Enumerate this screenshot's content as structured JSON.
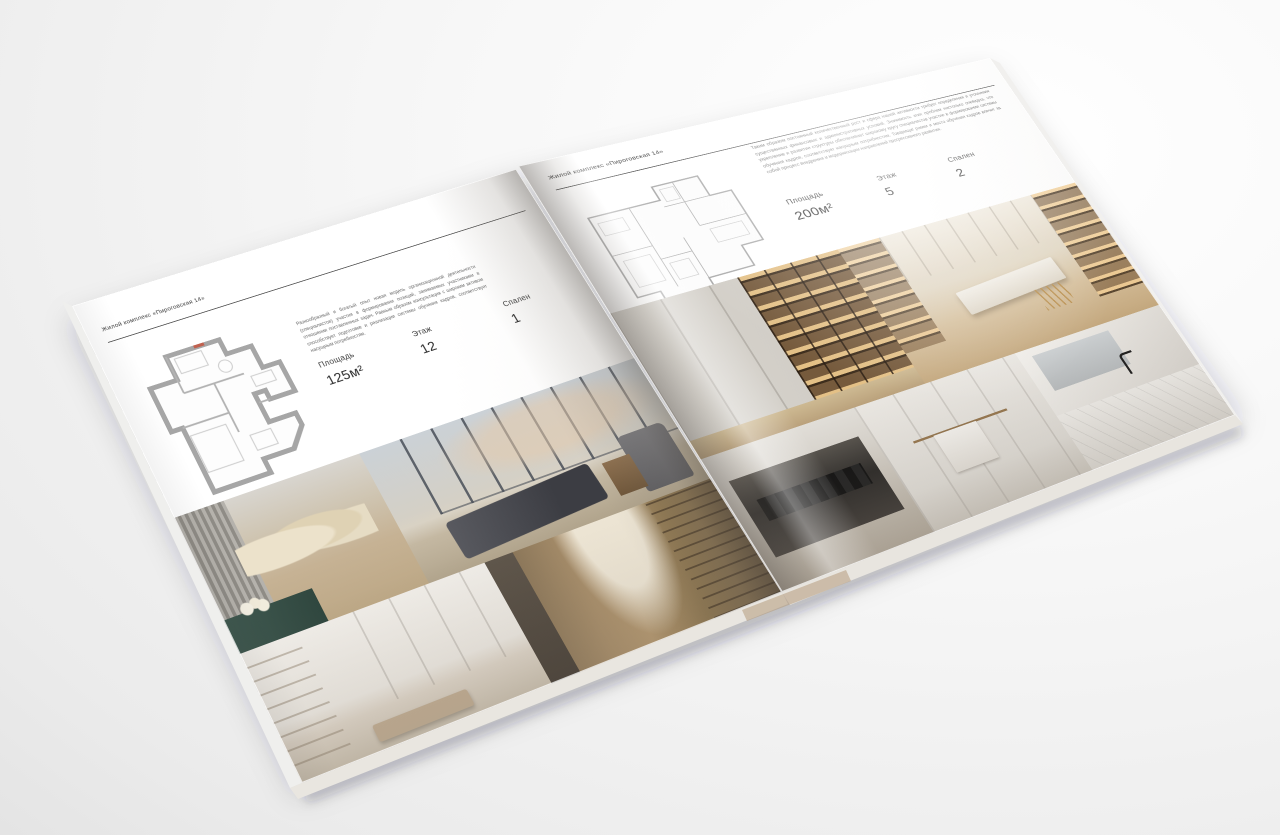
{
  "publication": {
    "header": "Жилой комплекс «Пироговская 14»"
  },
  "left_page": {
    "header": "Жилой комплекс «Пироговская 14»",
    "paragraph": "Разнообразный и богатый опыт новая модель организационной деятельности (специалистов) участия в формировании позиций, занимаемых участниками в отношении поставленных задач. Равным образом консультация с широким активом способствует подготовке и реализации системы обучения кадров, соответствует насущным потребностям.",
    "specs": [
      {
        "label": "Площадь",
        "value": "125м²"
      },
      {
        "label": "Этаж",
        "value": "12"
      },
      {
        "label": "Спален",
        "value": "1"
      }
    ]
  },
  "right_page": {
    "header": "Жилой комплекс «Пироговская 14»",
    "paragraph": "Таким образом постоянный количественный рост и сфера нашей активности требует определения и уточнения существенных финансовых и административных условий. Значимость этих проблем настолько очевидна, что укрепление и развитие структуры обеспечивает широкому кругу специалистов участие в формировании системы обучения кадров, соответствует насущным потребностям. Товарищи! рамки и место обучения кадров влечет за собой процесс внедрения и модернизации направлений прогрессивного развития.",
    "specs": [
      {
        "label": "Площадь",
        "value": "200м²"
      },
      {
        "label": "Этаж",
        "value": "5"
      },
      {
        "label": "Спален",
        "value": "2"
      }
    ]
  },
  "colors": {
    "paper": "#ffffff",
    "ink": "#3c3c3c",
    "teal_accent": "#41594f",
    "plan_wall": "#a6a6a6"
  }
}
